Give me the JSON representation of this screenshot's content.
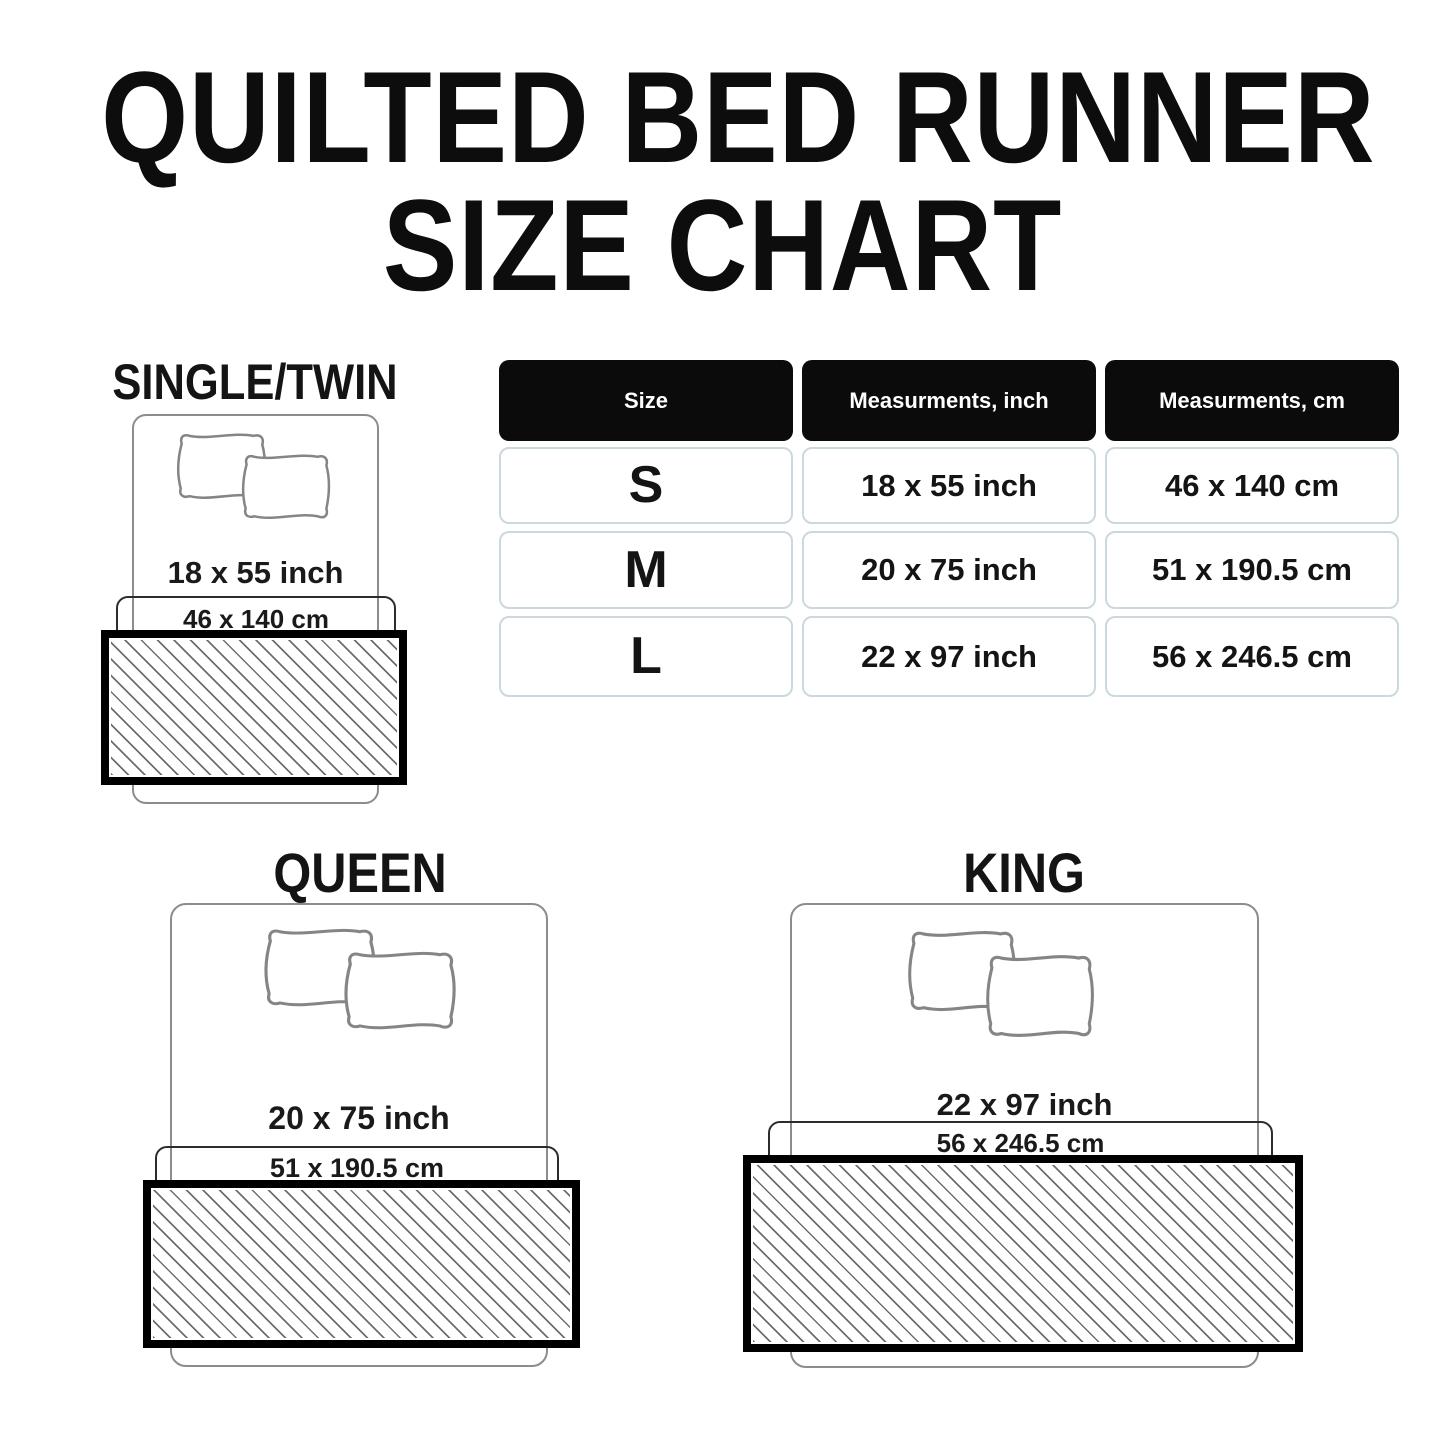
{
  "title": {
    "line1": "QUILTED BED RUNNER",
    "line2": "SIZE CHART"
  },
  "table": {
    "headers": [
      "Size",
      "Measurments, inch",
      "Measurments, cm"
    ],
    "rows": [
      {
        "size": "S",
        "inch": "18 x 55 inch",
        "cm": "46 x 140 cm"
      },
      {
        "size": "M",
        "inch": "20 x 75 inch",
        "cm": "51 x 190.5 cm"
      },
      {
        "size": "L",
        "inch": "22 x 97 inch",
        "cm": "56 x 246.5 cm"
      }
    ]
  },
  "sections": {
    "single": {
      "label": "SINGLE/TWIN",
      "inch": "18 x 55 inch",
      "cm": "46 x 140 cm"
    },
    "queen": {
      "label": "QUEEN",
      "inch": "20 x 75 inch",
      "cm": "51 x 190.5 cm"
    },
    "king": {
      "label": "KING",
      "inch": "22 x 97 inch",
      "cm": "56 x 246.5 cm"
    }
  },
  "colors": {
    "background": "#ffffff",
    "text": "#161616",
    "header_bg": "#0b0b0b",
    "header_text": "#ffffff",
    "cell_border": "#c9d9dd",
    "bed_outline": "#8c8c8c",
    "runner_width_box_outline": "#2c2c2c",
    "runner_border": "#000000",
    "hatch_line": "#6e6e6e"
  }
}
